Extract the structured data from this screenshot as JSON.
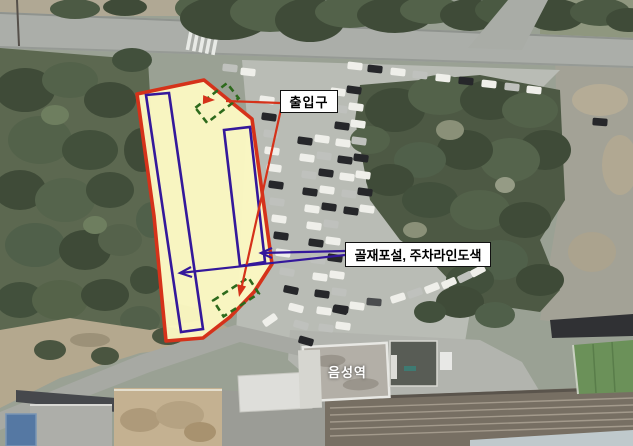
{
  "labels": {
    "entrance": "출입구",
    "work": "골재포설, 주차라인도색",
    "station": "음성역"
  },
  "annotations": {
    "site_area": "parcel to be improved (yellow fill, red outline)",
    "parking_row_outlines": 2,
    "entrance_markers": 2
  },
  "colors": {
    "site_fill": "#FBF8C2",
    "site_border": "#D5321A",
    "marking_blue": "#34189B",
    "entrance_green": "#2D6A1C",
    "label_bg": "#FFFFFF",
    "label_border": "#111111",
    "station_text": "#FFFFFF"
  }
}
